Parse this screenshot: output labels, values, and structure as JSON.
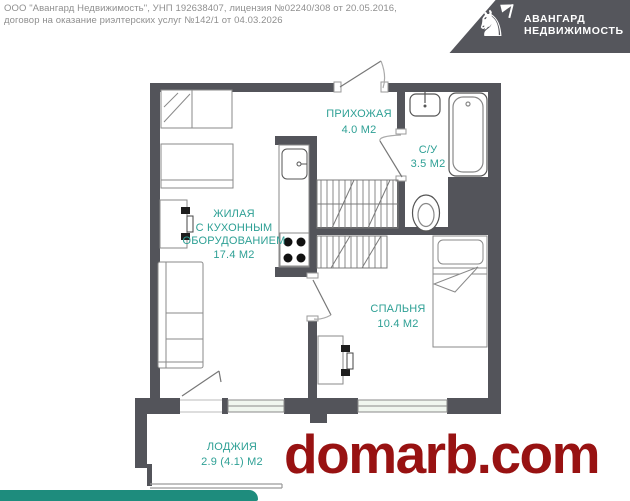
{
  "header": {
    "disclaimer_line1": "ООО \"Авангард Недвижимость\", УНП 192638407, лицензия №02240/308 от 20.05.2016,",
    "disclaimer_line2": "договор на оказание риэлтерских услуг №142/1 от 04.03.2026",
    "logo": {
      "icon_glyph": "♞",
      "title_line1": "АВАНГАРД",
      "title_line2": "НЕДВИЖИМОСТЬ"
    }
  },
  "floorplan": {
    "rooms": {
      "hallway": {
        "name": "ПРИХОЖАЯ",
        "area": "4.0 М2"
      },
      "bathroom": {
        "name": "С/У",
        "area": "3.5 М2"
      },
      "living": {
        "name_line1": "ЖИЛАЯ",
        "name_line2": "С КУХОННЫМ",
        "name_line3": "ОБОРУДОВАНИЕМ",
        "area": "17.4 М2"
      },
      "bedroom": {
        "name": "СПАЛЬНЯ",
        "area": "10.4 М2"
      },
      "loggia": {
        "name": "ЛОДЖИЯ",
        "area": "2.9 (4.1) М2"
      }
    }
  },
  "watermark": {
    "text": "domarb.com"
  },
  "colors": {
    "wall": "#53545a",
    "label": "#2ea095",
    "watermark": "#981212",
    "logo_bg": "#55565c",
    "footer_bar": "#1e8c7d",
    "furniture_line": "#8a8a8a"
  }
}
